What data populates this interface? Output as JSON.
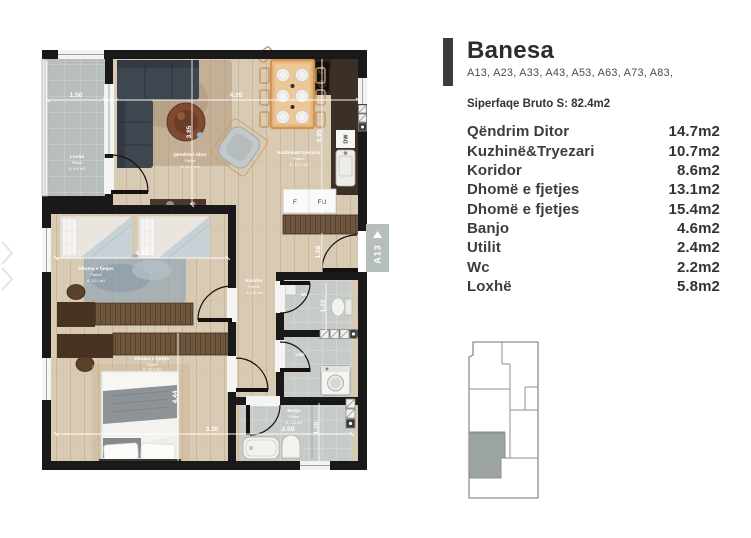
{
  "panel": {
    "title": "Banesa",
    "codes": "A13, A23, A33, A43, A53, A63, A73, A83,",
    "gross_area": "Siperfaqe Bruto S: 82.4m2",
    "rooms": [
      {
        "name": "Qëndrim Ditor",
        "area": "14.7m2"
      },
      {
        "name": "Kuzhinë&Tryezari",
        "area": "10.7m2"
      },
      {
        "name": "Koridor",
        "area": "8.6m2"
      },
      {
        "name": "Dhomë e fjetjes",
        "area": "13.1m2"
      },
      {
        "name": "Dhomë e fjetjes",
        "area": "15.4m2"
      },
      {
        "name": "Banjo",
        "area": "4.6m2"
      },
      {
        "name": "Utilit",
        "area": "2.4m2"
      },
      {
        "name": "Wc",
        "area": "2.2m2"
      },
      {
        "name": "Loxhë",
        "area": "5.8m2"
      }
    ]
  },
  "plan": {
    "unit_tag": "A13",
    "rooms": {
      "loxha": {
        "name": "Loxha",
        "floor": "Pllake",
        "area": "S: 5.8 m2"
      },
      "living": {
        "name": "Qendrimi Ditor",
        "floor": "Parket",
        "area": "S: 14.7 m2"
      },
      "kitchen": {
        "name": "Kuzhina&Tryezaria",
        "floor": "Parket",
        "area": "S: 10.7 m2"
      },
      "bedroom1": {
        "name": "Dhoma e fjetjes",
        "floor": "Parket",
        "area": "S: 13.1 m2"
      },
      "koridor": {
        "name": "Koridor",
        "floor": "Parket",
        "area": "S: 8.6 m2"
      },
      "bedroom2": {
        "name": "Dhoma e fjetjes",
        "floor": "Parket",
        "area": "S: 15.4 m2"
      },
      "banjo": {
        "name": "Banjo",
        "floor": "Pllake",
        "area": "S: 4.6 m2"
      },
      "wc": {
        "name": "Wc"
      },
      "utilit": {
        "name": "Utilit"
      }
    },
    "appliances": {
      "dishwasher": "DW",
      "fridge": "F",
      "freezer": "FU"
    },
    "dimensions": {
      "balcony_w": "1.50",
      "living_kitchen_w": "4.35",
      "living_h": "3.85",
      "kitchen_h": "3.95",
      "bedroom1_w": "4.42",
      "entry_h": "1.58",
      "wc_h": "1.22",
      "bedroom2_h": "4.44",
      "bedroom2_w": "3.20",
      "banjo_w": "2.00",
      "banjo_h": "1.10"
    }
  },
  "colors": {
    "accent_dark": "#3b3b3b",
    "wall": "#191919",
    "wood_floor": "#d9cab4",
    "tile_floor": "#b8beba",
    "unit_highlight": "#9ba49f"
  }
}
